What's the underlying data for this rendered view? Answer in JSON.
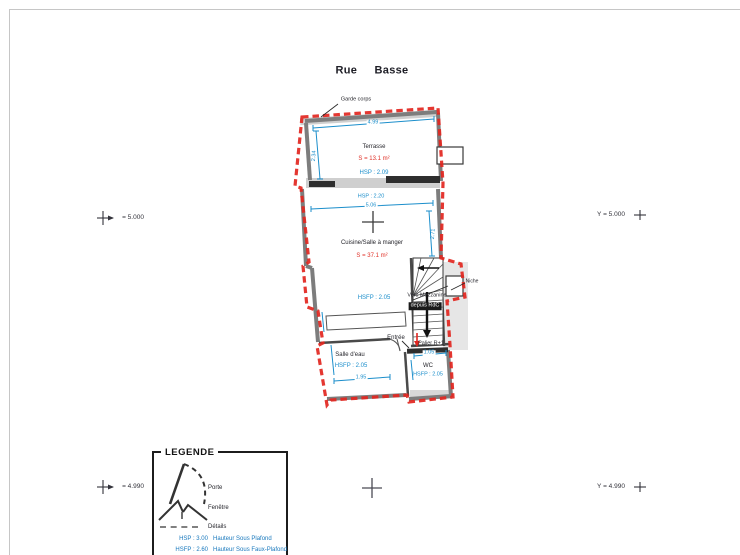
{
  "title": "Rue Basse",
  "markers": {
    "mid_left": "= 5.000",
    "mid_right": "Y = 5.000",
    "bottom_left": "= 4.990",
    "bottom_right": "Y = 4.990"
  },
  "plan": {
    "garde_corps": "Garde corps",
    "terrasse": {
      "name": "Terrasse",
      "area": "S = 13.1 m²",
      "ceiling": "HSP : 2.09",
      "width_dim": "4.99",
      "depth_dim": "2.34"
    },
    "cuisine": {
      "name": "Cuisine/Salle à manger",
      "area": "S = 37.1 m²",
      "ceiling": "HSP : 2.20",
      "false_ceiling": "HSFP : 2.05",
      "width_dim": "5.06",
      "depth_dim": "2.71"
    },
    "stairs": {
      "up_label": "Vers Mezzanine",
      "down_label": "depuis RdC",
      "landing": "Palier R+1",
      "niche": "Niche"
    },
    "entree": "Entrée",
    "salle_eau": {
      "name": "Salle d'eau",
      "false_ceiling": "HSFP : 2.05",
      "width_dim": "1.95"
    },
    "wc": {
      "name": "WC",
      "false_ceiling": "HSFP : 2.05",
      "width_dim": "1.05"
    }
  },
  "legend": {
    "title": "LEGENDE",
    "symbols": [
      {
        "label": "Porte"
      },
      {
        "label": "Fenêtre"
      },
      {
        "label": "Détails"
      }
    ],
    "heights": [
      {
        "key": "HSP : 3.00",
        "label": "Hauteur Sous Plafond"
      },
      {
        "key": "HSFP : 2.60",
        "label": "Hauteur Sous Faux-Plafond"
      }
    ]
  },
  "colors": {
    "dimension_blue": "#1b8ecb",
    "area_red": "#e03229",
    "boundary_red": "#e22620",
    "legend_blue": "#1878bd"
  }
}
